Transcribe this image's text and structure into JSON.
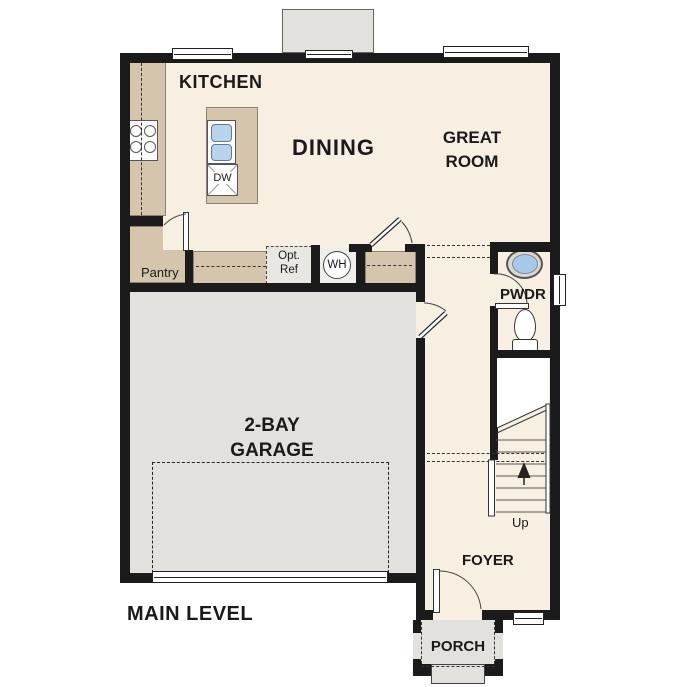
{
  "plan": {
    "title": "MAIN LEVEL",
    "rooms": {
      "kitchen": "KITCHEN",
      "dining": "DINING",
      "great_room": "GREAT ROOM",
      "garage": "2-BAY GARAGE",
      "foyer": "FOYER",
      "porch": "PORCH",
      "powder": "PWDR",
      "pantry": "Pantry"
    },
    "labels": {
      "opt_ref_1": "Opt.",
      "opt_ref_2": "Ref",
      "water_heater": "WH",
      "dishwasher": "DW",
      "stairs_up": "Up"
    },
    "colors": {
      "floor": "#f6efe2",
      "garage_floor": "#e3e1dd",
      "counter": "#d4c5ac",
      "wall": "#1b1b1b",
      "sink_blue": "#aecdea"
    }
  }
}
